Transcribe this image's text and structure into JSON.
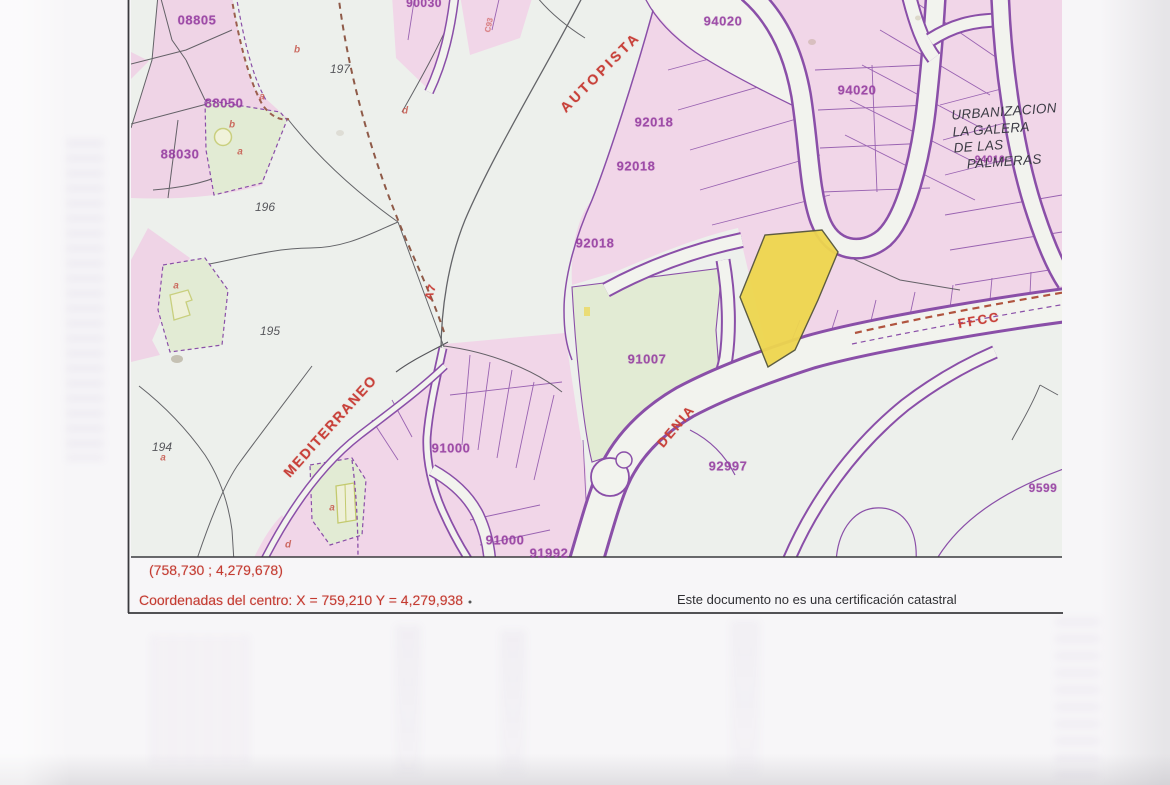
{
  "footer": {
    "corner_coordinates": "(758,730 ; 4,279,678)",
    "center_coordinates": "Coordenadas del centro: X = 759,210 Y = 4,279,938",
    "disclaimer": "Este documento no es una certificación catastral"
  },
  "map": {
    "urbanization_label": {
      "lines": [
        "URBANIZACION",
        "LA GALERA",
        "DE LAS",
        "PALMERAS"
      ]
    },
    "road_labels": [
      {
        "text": "AUTOPISTA",
        "x": 600,
        "y": 72,
        "rotation": -45,
        "size": 14,
        "spacing": 3
      },
      {
        "text": "A7",
        "x": 431,
        "y": 292,
        "rotation": -72,
        "size": 11,
        "spacing": 1
      },
      {
        "text": "MEDITERRANEO",
        "x": 330,
        "y": 426,
        "rotation": -48,
        "size": 14,
        "spacing": 1.5
      },
      {
        "text": "DENIA",
        "x": 676,
        "y": 426,
        "rotation": -50,
        "size": 13,
        "spacing": 2
      },
      {
        "text": "FFCC",
        "x": 979,
        "y": 320,
        "rotation": -10,
        "size": 13,
        "spacing": 2
      },
      {
        "text": "C93",
        "x": 489,
        "y": 25,
        "rotation": -78,
        "size": 8,
        "spacing": 0,
        "opacity": 0.55
      }
    ],
    "parcel_labels": [
      {
        "text": "08805",
        "x": 197,
        "y": 20
      },
      {
        "text": "88050",
        "x": 224,
        "y": 103
      },
      {
        "text": "88030",
        "x": 180,
        "y": 154
      },
      {
        "text": "90030",
        "x": 424,
        "y": 3,
        "size": 12
      },
      {
        "text": "92018",
        "x": 654,
        "y": 122
      },
      {
        "text": "92018",
        "x": 636,
        "y": 166
      },
      {
        "text": "92018",
        "x": 595,
        "y": 243
      },
      {
        "text": "91007",
        "x": 647,
        "y": 359
      },
      {
        "text": "94020",
        "x": 723,
        "y": 21
      },
      {
        "text": "94020",
        "x": 857,
        "y": 90
      },
      {
        "text": "94010",
        "x": 990,
        "y": 160,
        "size": 10
      },
      {
        "text": "91000",
        "x": 451,
        "y": 448
      },
      {
        "text": "91000",
        "x": 505,
        "y": 540
      },
      {
        "text": "91992",
        "x": 549,
        "y": 553
      },
      {
        "text": "92997",
        "x": 728,
        "y": 466
      },
      {
        "text": "9599",
        "x": 1043,
        "y": 488,
        "size": 12
      }
    ],
    "zone_labels": [
      {
        "text": "197",
        "x": 340,
        "y": 69
      },
      {
        "text": "196",
        "x": 265,
        "y": 207
      },
      {
        "text": "195",
        "x": 270,
        "y": 331
      },
      {
        "text": "194",
        "x": 162,
        "y": 447
      }
    ],
    "letter_marks": [
      {
        "text": "b",
        "x": 297,
        "y": 50
      },
      {
        "text": "a",
        "x": 262,
        "y": 97
      },
      {
        "text": "d",
        "x": 405,
        "y": 111
      },
      {
        "text": "b",
        "x": 232,
        "y": 125
      },
      {
        "text": "a",
        "x": 240,
        "y": 152
      },
      {
        "text": "a",
        "x": 176,
        "y": 286
      },
      {
        "text": "a",
        "x": 163,
        "y": 458
      },
      {
        "text": "a",
        "x": 332,
        "y": 508
      },
      {
        "text": "d",
        "x": 288,
        "y": 545
      }
    ],
    "colors": {
      "parcel_pink": "#f1d6e8",
      "parcel_green": "#e2ebd4",
      "highlight_yellow": "#eed64e",
      "line_purple": "#8a4fa8",
      "label_purple": "#93399f",
      "road_red": "#c8413a",
      "ink_black": "#4c4c52",
      "paper": "#edf0ec"
    }
  }
}
